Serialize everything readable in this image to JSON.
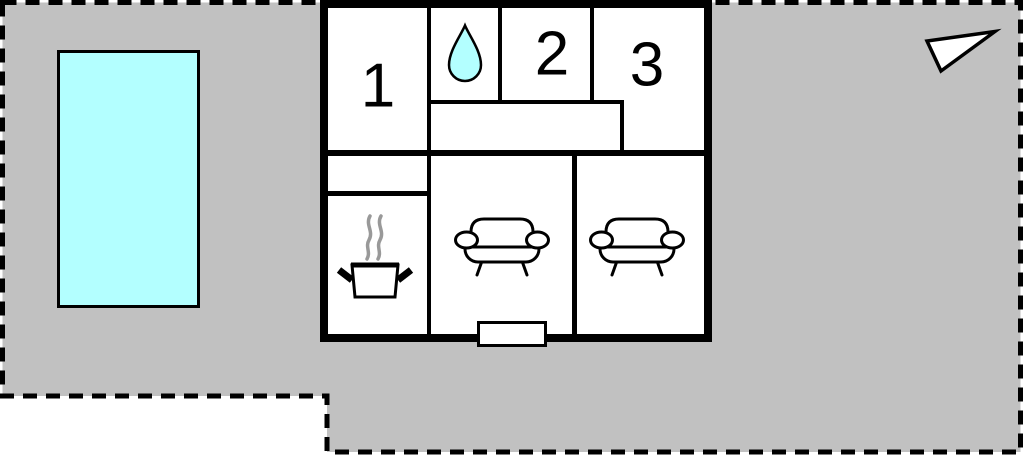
{
  "floorplan": {
    "rooms": {
      "bedroom1": {
        "label": "1"
      },
      "bedroom2": {
        "label": "2"
      },
      "bedroom3": {
        "label": "3"
      },
      "bathroom": {
        "icon": "water-drop"
      },
      "kitchen": {
        "icon": "steaming-pot"
      },
      "living_room_1": {
        "icon": "sofa"
      },
      "living_room_2": {
        "icon": "sofa"
      }
    },
    "outside": {
      "pool": {
        "icon": "swimming-pool"
      },
      "compass": {
        "icon": "north-arrow"
      }
    },
    "colors": {
      "plot-gray": "#c1c1c1",
      "pool-cyan": "#b3ffff",
      "line-black": "#000000",
      "steam-gray": "#999999",
      "bg-white": "#ffffff"
    }
  }
}
